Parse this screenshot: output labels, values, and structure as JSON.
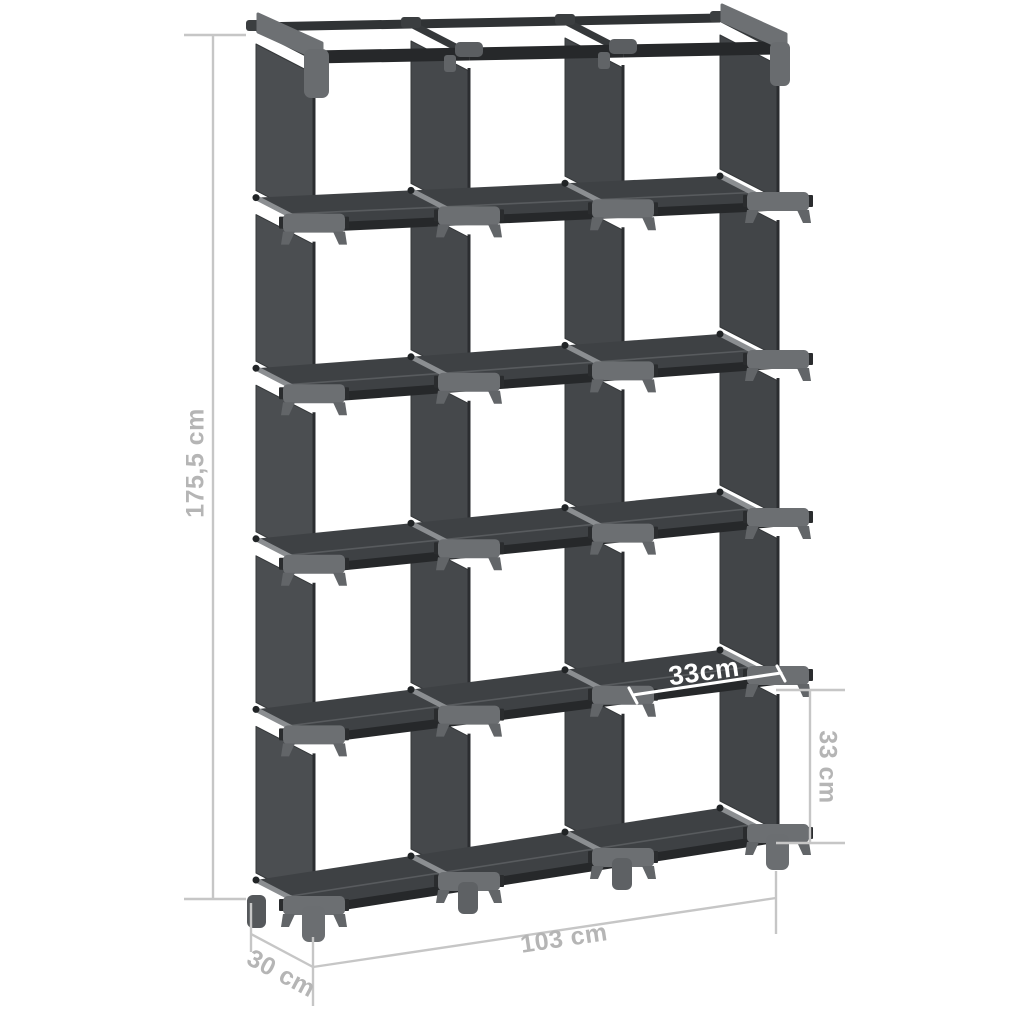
{
  "page": {
    "background": "#ffffff",
    "description": "Product dimension diagram of a dark grey fabric cube storage shelf"
  },
  "product": {
    "rows": 5,
    "columns": 3,
    "cube_count": 15
  },
  "dimensions": {
    "height": {
      "label": "175,5 cm",
      "placement": "left-vertical"
    },
    "width": {
      "label": "103 cm",
      "placement": "bottom"
    },
    "depth": {
      "label": "30 cm",
      "placement": "bottom-left-diagonal"
    },
    "cube_height": {
      "label": "33 cm",
      "placement": "right-vertical"
    },
    "cube_width": {
      "label": "33cm",
      "placement": "on-shelf-white"
    }
  },
  "colors": {
    "background": "#ffffff",
    "fabric_panel": "#46494c",
    "shelf_board": "#3e4144",
    "frame_rail": "#26282a",
    "connector": "#6c6f72",
    "depth_tube": "#8b8e91",
    "dimension_line": "#c6c6c6",
    "dimension_text": "#b5b5b5",
    "cube_width_text": "#ffffff"
  }
}
